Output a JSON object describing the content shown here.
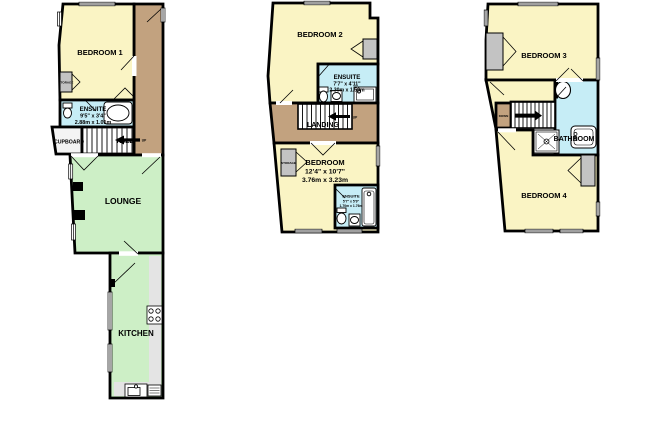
{
  "document": {
    "type": "floorplan",
    "background": "#ffffff"
  },
  "colors": {
    "room": "#FAF4C4",
    "wet": "#C6EDF6",
    "living": "#CDEFC6",
    "hall": "#C2A27F",
    "storage": "#C3C3C3",
    "counter": "#E4E4E4",
    "wall": "#000000"
  },
  "floors": [
    {
      "name": "ground-floor",
      "labels": {
        "bedroom1": "BEDROOM 1",
        "storage": "STORAGE",
        "ensuite": "ENSUITE",
        "ensuite_imperial": "9'5\" x 3'4\"",
        "ensuite_metric": "2.88m x 1.01m",
        "cupboard": "CUPBOARD",
        "hall": "HALL",
        "hall_direction": "UP",
        "lounge": "LOUNGE",
        "kitchen": "KITCHEN"
      }
    },
    {
      "name": "first-floor",
      "labels": {
        "bedroom2": "BEDROOM 2",
        "ensuite": "ENSUITE",
        "ensuite_imperial": "7'7\" x 4'11\"",
        "ensuite_metric": "2.30m x 1.50m",
        "landing": "LANDING",
        "landing_direction": "UP",
        "storage": "STORAGE",
        "bedroom": "BEDROOM",
        "bedroom_imperial": "12'4\" x 10'7\"",
        "bedroom_metric": "3.76m x 3.23m",
        "ensuite2": "ENSUITE",
        "ensuite2_imperial": "5'7\" x 5'9\"",
        "ensuite2_metric": "1.70m x 1.76m"
      }
    },
    {
      "name": "second-floor",
      "labels": {
        "bedroom3": "BEDROOM 3",
        "stairs_direction": "DOWN",
        "bathroom": "BATHROOM",
        "bedroom4": "BEDROOM 4"
      }
    }
  ]
}
